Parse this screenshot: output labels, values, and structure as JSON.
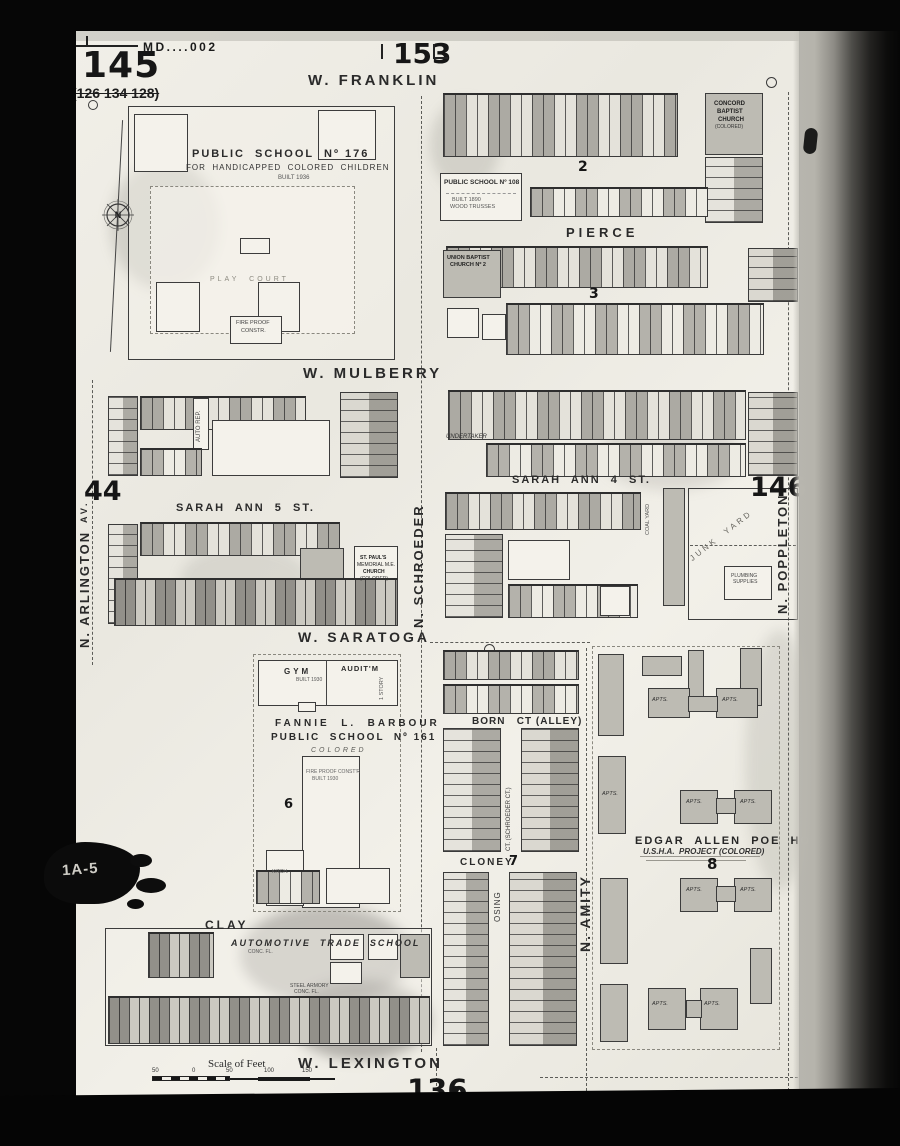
{
  "sheet": {
    "number": "145",
    "cross_ref": "(126 134 128)",
    "plate": "MD....002",
    "adj_top": "153",
    "adj_bottom": "136",
    "adj_left": "44",
    "adj_right": "146",
    "blot": "1A-5"
  },
  "streets": {
    "w_franklin": "W. FRANKLIN",
    "pierce": "PIERCE",
    "w_mulberry": "W. MULBERRY",
    "sarah_ann_4": "SARAH  ANN  4  ST.",
    "sarah_ann_5": "SARAH  ANN  5  ST.",
    "w_saratoga": "W. SARATOGA",
    "born_ct": "BORN   CT (ALLEY)",
    "cloney": "CLONEY",
    "clay": "CLAY",
    "w_lexington": "W. LEXINGTON",
    "n_arlington": "N. ARLINGTON",
    "arlington_av": "AV.",
    "n_schroeder": "N. SCHROEDER",
    "n_amity": "N. AMITY",
    "n_poppleton": "N. POPPLETON",
    "osing": "OSING",
    "schroeder_ct": "CT. (SCHROEDER CT.)"
  },
  "blocks": {
    "b2": "2",
    "b3": "3",
    "b6": "6",
    "b7": "7",
    "b8": "8"
  },
  "landmarks": {
    "school176_1": "PUBLIC  SCHOOL  Nº 176",
    "school176_2": "FOR  HANDICAPPED  COLORED  CHILDREN",
    "school176_built": "BUILT 1936",
    "play_court": "PLAY  COURT",
    "fire_proof_1": "FIRE PROOF",
    "fire_proof_2": "CONSTR.",
    "school108_1": "PUBLIC SCHOOL Nº 108",
    "school108_2": "BUILT 1890",
    "school108_3": "WOOD TRUSSES",
    "concord_1": "CONCORD",
    "concord_2": "BAPTIST",
    "concord_3": "CHURCH",
    "concord_4": "(COLORED)",
    "union_1": "UNION BAPTIST",
    "union_2": "CHURCH Nº 2",
    "stpauls_1": "ST. PAUL'S",
    "stpauls_2": "MEMORIAL M.E.",
    "stpauls_3": "CHURCH",
    "stpauls_4": "(COLORED)",
    "undertaker": "UNDERTAKER",
    "gym": "GYM",
    "auditm": "AUDIT'M",
    "gym_built": "BUILT 1930",
    "one_story": "1 STORY",
    "kitchen": "KITCH.",
    "barbour_1": "FANNIE  L.  BARBOUR",
    "barbour_2": "PUBLIC  SCHOOL  Nº 161",
    "barbour_3": "COLORED",
    "barbour_note1": "FIRE PROOF CONST'R",
    "barbour_note2": "BUILT 1930",
    "poe_1": "EDGAR  ALLEN  POE  HOMES",
    "poe_2": "U.S.H.A.  PROJECT (COLORED)",
    "apts": "APTS.",
    "automotive": "AUTOMOTIVE  TRADE  SCHOOL",
    "conc_fl": "CONC. FL.",
    "armory_1": "STEEL ARMORY",
    "armory_2": "CONC. FL.",
    "junk_yard": "JUNK  YARD",
    "coal_yard": "COAL YARD",
    "plumbing_1": "PLUMBING",
    "plumbing_2": "SUPPLIES",
    "auto_rep": "AUTO REP."
  },
  "scale": {
    "label": "Scale of Feet",
    "ticks": [
      "50",
      "0",
      "50",
      "100",
      "150"
    ]
  },
  "compass": {
    "letter": "N"
  }
}
